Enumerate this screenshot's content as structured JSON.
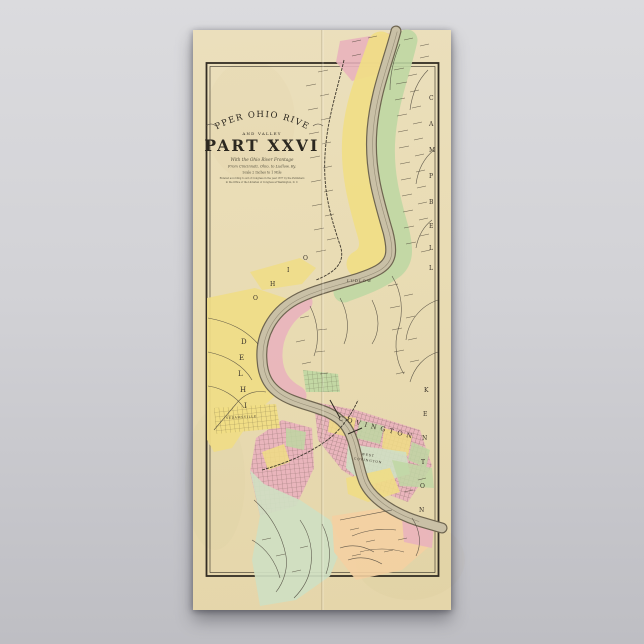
{
  "poster": {
    "title_arc": "UPPER OHIO RIVER",
    "title_small": "AND VALLEY",
    "title_main": "PART XXVI",
    "subtitle": {
      "line1": "With the Ohio River Frontage",
      "line2": "From Cincinnati, Ohio, to Ludlow, Ky.",
      "line3": "Scale 2 Inches to 1 Mile",
      "line4": "Entered according to Act of Congress in the year 1877 by the Publishers",
      "line5": "in the Office of the Librarian of Congress at Washington, D. C."
    }
  },
  "map": {
    "labels": {
      "city": "COVINGTON",
      "west_line1": "WEST",
      "west_line2": "COVINGTON",
      "ludlow": "LUDLOW",
      "sedamsville": "SEDAMSVILLE"
    },
    "letters": {
      "campbell": [
        "C",
        "A",
        "M",
        "P",
        "B",
        "E",
        "L",
        "L"
      ],
      "kenton": [
        "K",
        "E",
        "N",
        "T",
        "O",
        "N"
      ],
      "delhi": [
        "D",
        "E",
        "L",
        "H",
        "I"
      ],
      "ohio": [
        "O",
        "H",
        "I",
        "O"
      ]
    },
    "colors": {
      "paper": "#e9dcb4",
      "frame_ink": "#332d24",
      "yellow": "#f0dd85",
      "pink": "#e9b2bd",
      "green": "#bfd7a3",
      "pale_green": "#cfe0c2",
      "peach": "#f4d0a2",
      "river": "#c9c0a6",
      "river_edge": "#6e6550",
      "ink": "#3b342a",
      "title_ink": "#2c2820"
    }
  }
}
